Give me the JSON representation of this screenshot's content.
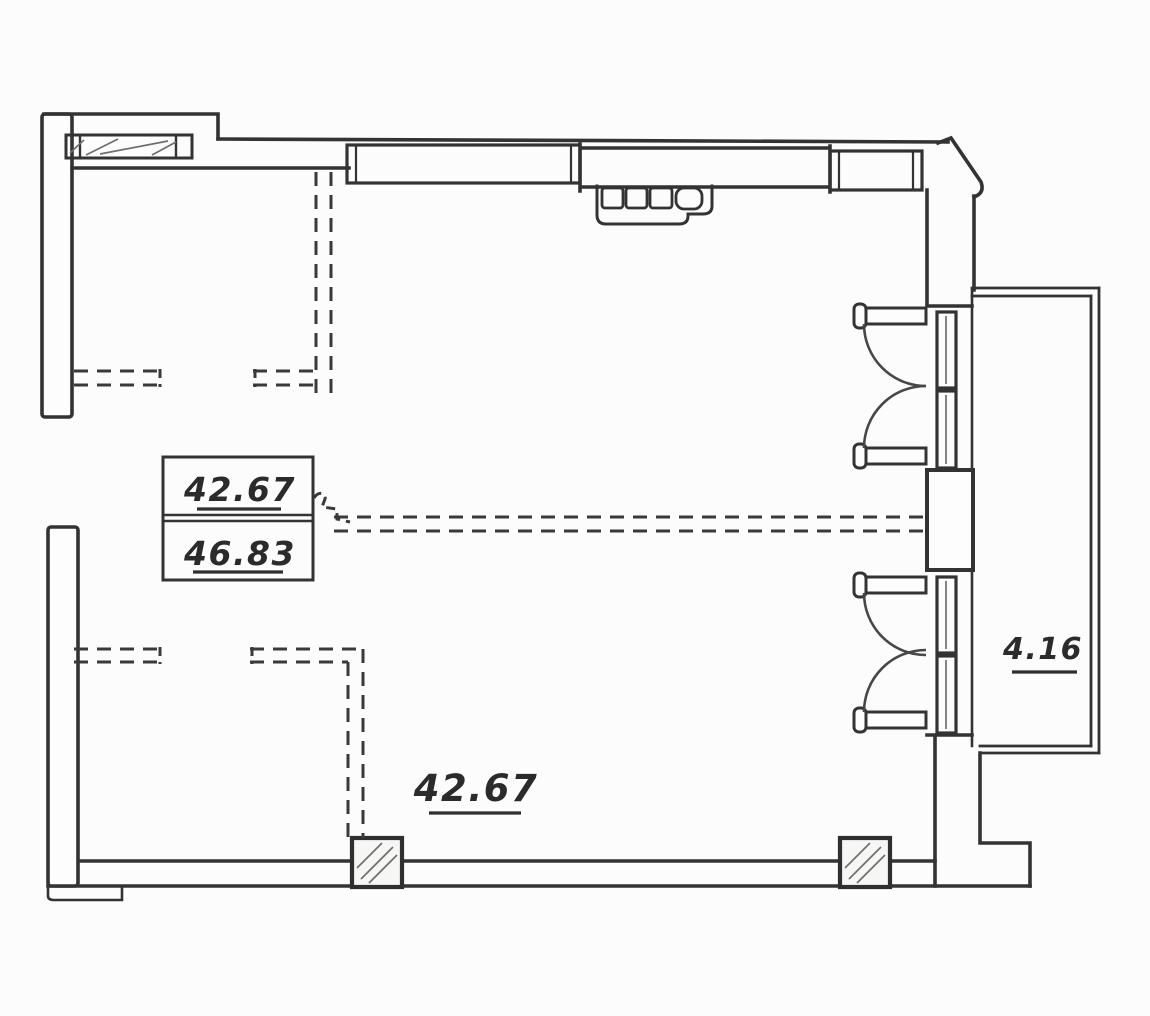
{
  "colors": {
    "ink": "#333333",
    "paper": "#fcfcfc"
  },
  "labels": {
    "area_table": {
      "row1": "42.67",
      "row2": "46.83"
    },
    "main_room_area": "42.67",
    "balcony_area": "4.16"
  }
}
